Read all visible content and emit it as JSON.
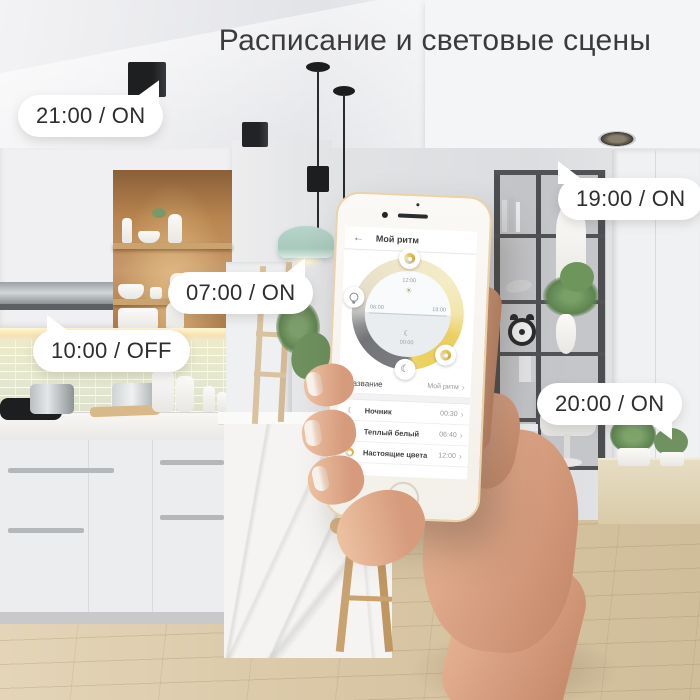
{
  "title": "Расписание и световые сцены",
  "callouts": {
    "c2100": "21:00 / ON",
    "c0700": "07:00 / ON",
    "c1000": "10:00 / OFF",
    "c1900": "19:00 / ON",
    "c2000": "20:00 / ON"
  },
  "phone": {
    "header": {
      "back": "←",
      "title": "Мой ритм"
    },
    "dial": {
      "top_time": "12:00",
      "left_time": "06:00",
      "right_time": "18:00",
      "bottom_time": "00:00",
      "sun": "☀",
      "moon": "☾"
    },
    "name_row": {
      "label": "Название",
      "value": "Мой ритм",
      "chevron": "›"
    },
    "scenes": [
      {
        "icon": "night-light-icon",
        "glyph": "☾",
        "label": "Ночник",
        "time": "00:30",
        "chevron": "›"
      },
      {
        "icon": "warm-white-bulb-icon",
        "label": "Теплый белый",
        "time": "06:40",
        "chevron": "›"
      },
      {
        "icon": "true-colors-palette-icon",
        "label": "Настоящие цвета",
        "time": "12:00",
        "chevron": "›"
      }
    ]
  },
  "colors": {
    "ring_yellow": "#f0d469",
    "ring_cream": "#f2e9c8",
    "ring_gray": "#77787b",
    "phone_gold": "#ecd2a9",
    "bubble_bg": "#ffffff",
    "title_color": "#3b3b3d"
  }
}
